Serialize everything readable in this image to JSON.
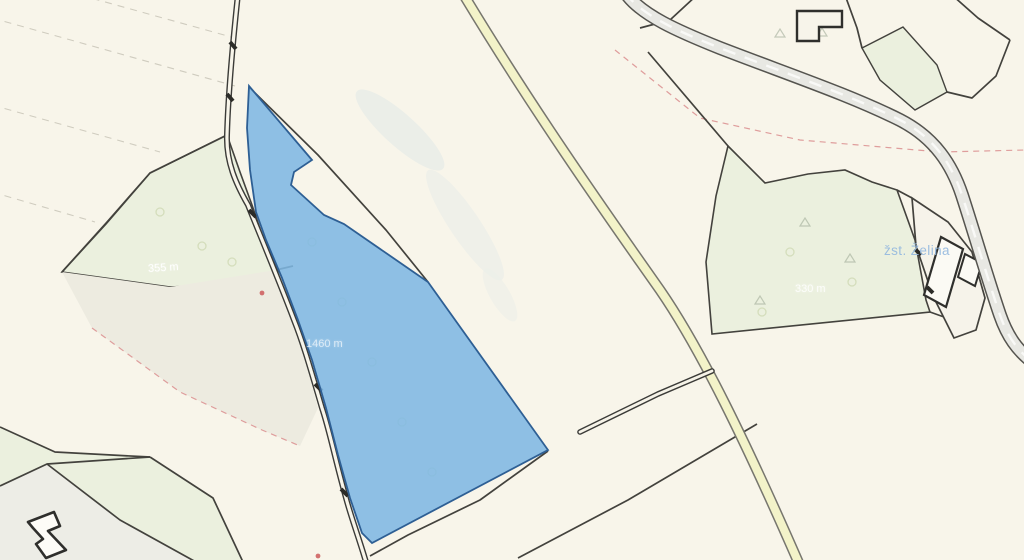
{
  "map": {
    "type": "cadastral-parcel-map",
    "labels": {
      "railway_station": "žst. Želina",
      "measure_left": "355 m",
      "measure_right": "330 m",
      "measure_selected": "1460 m"
    },
    "colors": {
      "background": "#f8f5ea",
      "selected_parcel_fill": "#7eb7e3",
      "selected_parcel_border": "#2e5f94",
      "woodland_fill": "#ebf0de",
      "tinted_parcel_fill": "#edebe0",
      "road_yellow_fill": "#f3f3c9",
      "road_gray_fill": "#e8e8e3",
      "boundary_line": "#43423d",
      "red_dashed_line": "#dc9494",
      "gray_dashed_line": "#c9c5b8",
      "station_label": "#94b9de"
    }
  }
}
